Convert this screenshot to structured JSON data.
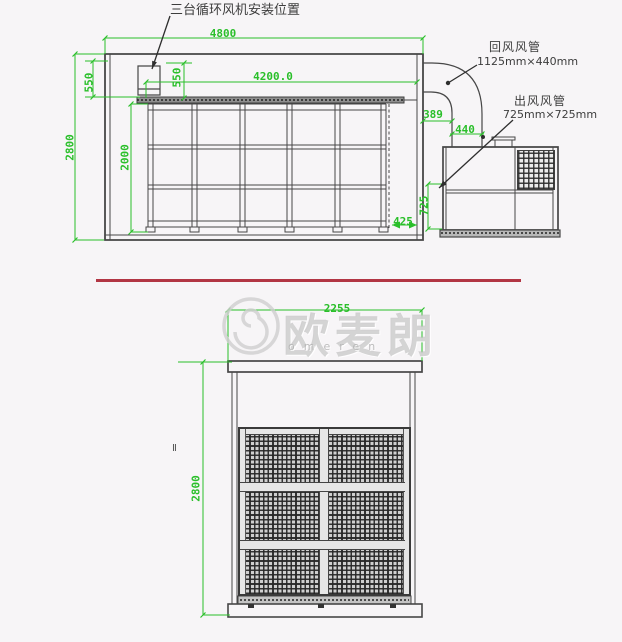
{
  "colors": {
    "background": "#f7f5f7",
    "dimension_green": "#2abf2a",
    "line_dark": "#474747",
    "divider_red": "#b23644",
    "watermark_gray": "#d5d5d5"
  },
  "top_view": {
    "fan_position_label": "三台循环风机安装位置",
    "return_duct": {
      "title": "回风风管",
      "size": "1125mm×440mm"
    },
    "outlet_duct": {
      "title": "出风风管",
      "size": "725mm×725mm"
    },
    "dims": {
      "overall_length": "4800",
      "rack_span": "4200.0",
      "room_height": "2800",
      "rack_height": "2000",
      "fan_zone_height": "550",
      "ceiling_gap": "550",
      "duct_offset": "389",
      "return_duct_width": "440",
      "outlet_height": "725",
      "end_gap": "425"
    }
  },
  "front_view": {
    "dims": {
      "overall_height": "2800",
      "overall_width": "2255"
    },
    "section_mark": "Ⅱ"
  },
  "watermark": {
    "brand_cn": "欧麦朗",
    "brand_en": "omeren"
  }
}
